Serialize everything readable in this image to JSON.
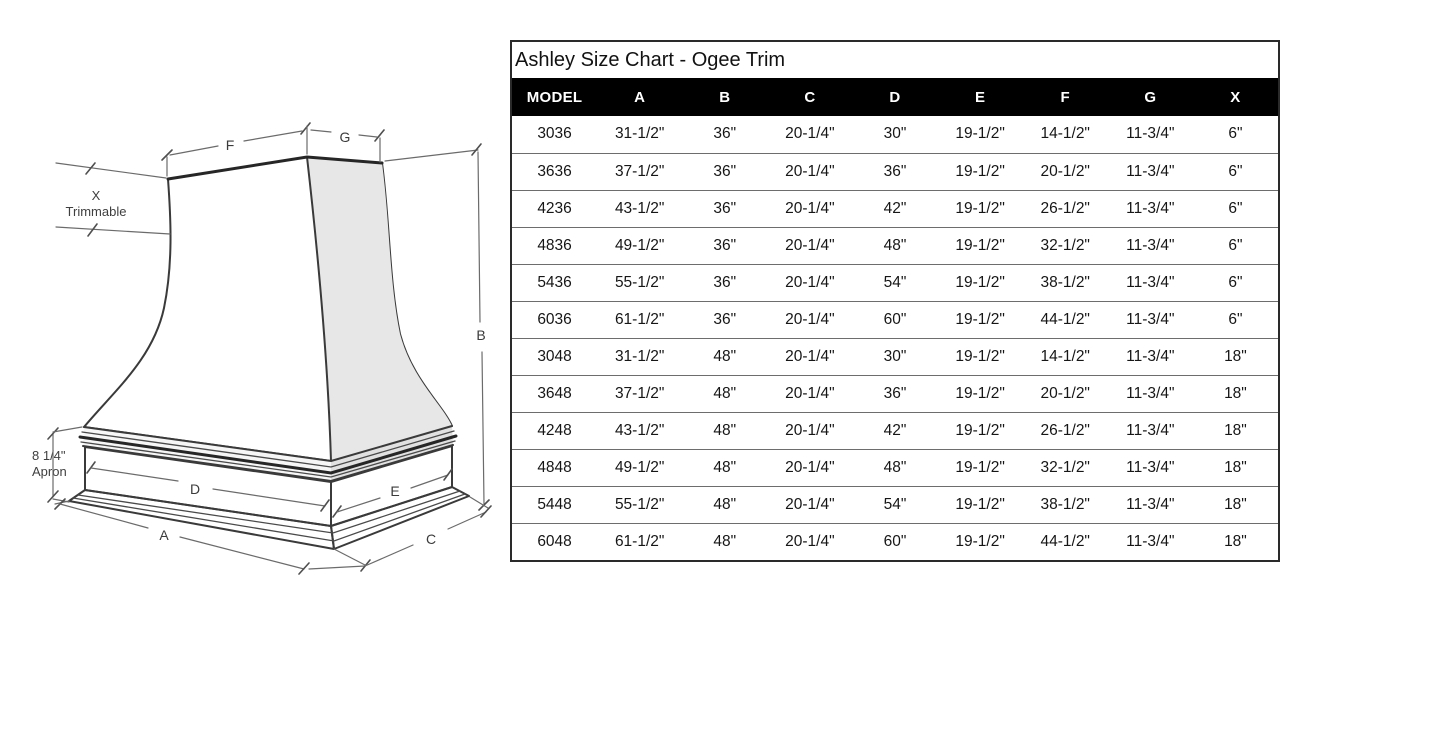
{
  "table": {
    "title": "Ashley Size Chart - Ogee Trim",
    "columns": [
      "MODEL",
      "A",
      "B",
      "C",
      "D",
      "E",
      "F",
      "G",
      "X"
    ],
    "rows": [
      [
        "3036",
        "31-1/2\"",
        "36\"",
        "20-1/4\"",
        "30\"",
        "19-1/2\"",
        "14-1/2\"",
        "11-3/4\"",
        "6\""
      ],
      [
        "3636",
        "37-1/2\"",
        "36\"",
        "20-1/4\"",
        "36\"",
        "19-1/2\"",
        "20-1/2\"",
        "11-3/4\"",
        "6\""
      ],
      [
        "4236",
        "43-1/2\"",
        "36\"",
        "20-1/4\"",
        "42\"",
        "19-1/2\"",
        "26-1/2\"",
        "11-3/4\"",
        "6\""
      ],
      [
        "4836",
        "49-1/2\"",
        "36\"",
        "20-1/4\"",
        "48\"",
        "19-1/2\"",
        "32-1/2\"",
        "11-3/4\"",
        "6\""
      ],
      [
        "5436",
        "55-1/2\"",
        "36\"",
        "20-1/4\"",
        "54\"",
        "19-1/2\"",
        "38-1/2\"",
        "11-3/4\"",
        "6\""
      ],
      [
        "6036",
        "61-1/2\"",
        "36\"",
        "20-1/4\"",
        "60\"",
        "19-1/2\"",
        "44-1/2\"",
        "11-3/4\"",
        "6\""
      ],
      [
        "3048",
        "31-1/2\"",
        "48\"",
        "20-1/4\"",
        "30\"",
        "19-1/2\"",
        "14-1/2\"",
        "11-3/4\"",
        "18\""
      ],
      [
        "3648",
        "37-1/2\"",
        "48\"",
        "20-1/4\"",
        "36\"",
        "19-1/2\"",
        "20-1/2\"",
        "11-3/4\"",
        "18\""
      ],
      [
        "4248",
        "43-1/2\"",
        "48\"",
        "20-1/4\"",
        "42\"",
        "19-1/2\"",
        "26-1/2\"",
        "11-3/4\"",
        "18\""
      ],
      [
        "4848",
        "49-1/2\"",
        "48\"",
        "20-1/4\"",
        "48\"",
        "19-1/2\"",
        "32-1/2\"",
        "11-3/4\"",
        "18\""
      ],
      [
        "5448",
        "55-1/2\"",
        "48\"",
        "20-1/4\"",
        "54\"",
        "19-1/2\"",
        "38-1/2\"",
        "11-3/4\"",
        "18\""
      ],
      [
        "6048",
        "61-1/2\"",
        "48\"",
        "20-1/4\"",
        "60\"",
        "19-1/2\"",
        "44-1/2\"",
        "11-3/4\"",
        "18\""
      ]
    ]
  },
  "diagram": {
    "labels": {
      "f": "F",
      "g": "G",
      "b": "B",
      "a": "A",
      "c": "C",
      "d": "D",
      "e": "E",
      "x_title": "X",
      "x_subtitle": "Trimmable",
      "apron_size": "8 1/4\"",
      "apron_label": "Apron"
    }
  },
  "colors": {
    "header_bg": "#000000",
    "header_text": "#ffffff",
    "row_border": "#6d6d6d",
    "table_border": "#2a2a2a",
    "sketch_line": "#3a3a3a",
    "side_shade": "#e7e7e7"
  }
}
